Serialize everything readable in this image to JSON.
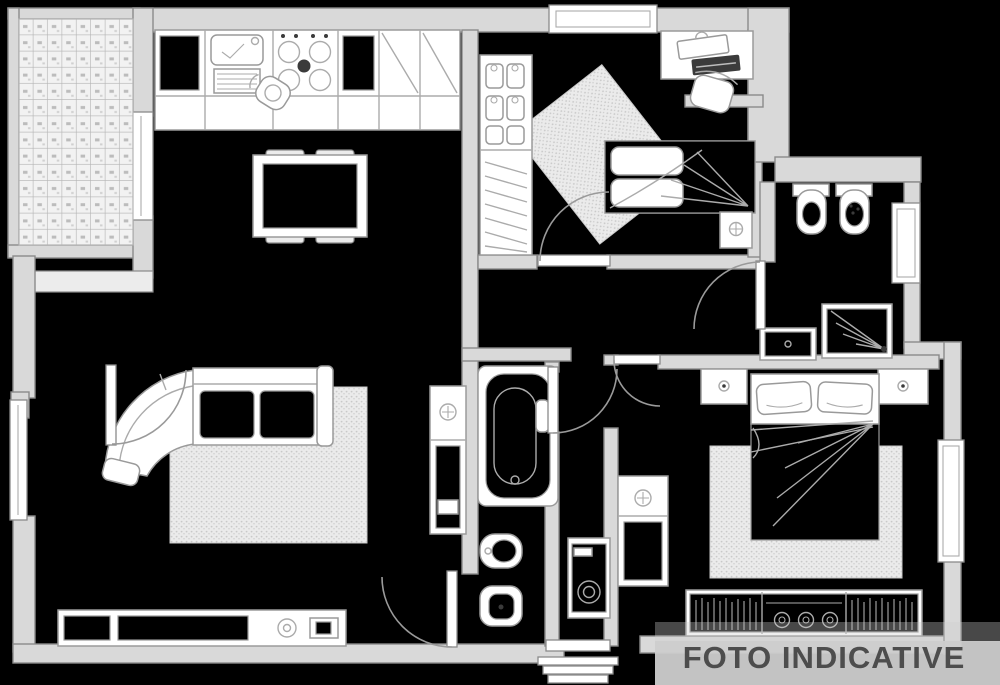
{
  "watermark": {
    "text": "FOTO INDICATIVE"
  },
  "colors": {
    "background": "#000000",
    "wall_fill": "#d9d9d9",
    "wall_stroke": "#8a8a8a",
    "beam_fill": "#ececec",
    "furniture_fill": "#ffffff",
    "furniture_stroke": "#9a9a9a",
    "detail_stroke": "#ababab",
    "dark_item": "#3b3b3b",
    "tile_fill": "#f2f2f2",
    "tile_stroke": "#b3b3b3",
    "tile_speck": "#8f8f8f",
    "rug_fill": "#ebebeb",
    "rug_dot": "#c9c9c9",
    "watermark_band": "#cdcdcd",
    "watermark_text": "#4d4d4d"
  },
  "plan": {
    "rooms": [
      {
        "name": "terrace",
        "features": [
          "tiled-floor",
          "window-to-kitchen"
        ]
      },
      {
        "name": "kitchen-dining",
        "features": [
          "kitchen-counter",
          "sink",
          "stove",
          "corner-cabinets",
          "stool",
          "dining-table",
          "four-chairs"
        ]
      },
      {
        "name": "living-room",
        "features": [
          "corner-sofa",
          "rug",
          "sideboard",
          "media-unit",
          "tall-cabinet",
          "window",
          "door-to-hall",
          "door-to-kitchen"
        ]
      },
      {
        "name": "bedroom",
        "features": [
          "single-bed",
          "wardrobe-with-hangers",
          "rug",
          "desk",
          "desk-chair",
          "bedside-unit",
          "top-window",
          "door"
        ]
      },
      {
        "name": "bathroom-top",
        "features": [
          "toilet",
          "bidet",
          "washbasin-unit",
          "shower",
          "cabinet",
          "window",
          "door"
        ]
      },
      {
        "name": "bathroom-center",
        "features": [
          "bathtub",
          "bidet",
          "toilet",
          "door"
        ]
      },
      {
        "name": "hallway",
        "features": [
          "washing-machine",
          "cabinet",
          "entry-door",
          "entry-steps"
        ]
      },
      {
        "name": "master-bedroom",
        "features": [
          "double-bed",
          "two-nightstands",
          "rug",
          "wardrobe-with-hangers",
          "cabinet",
          "window",
          "door"
        ]
      }
    ]
  }
}
